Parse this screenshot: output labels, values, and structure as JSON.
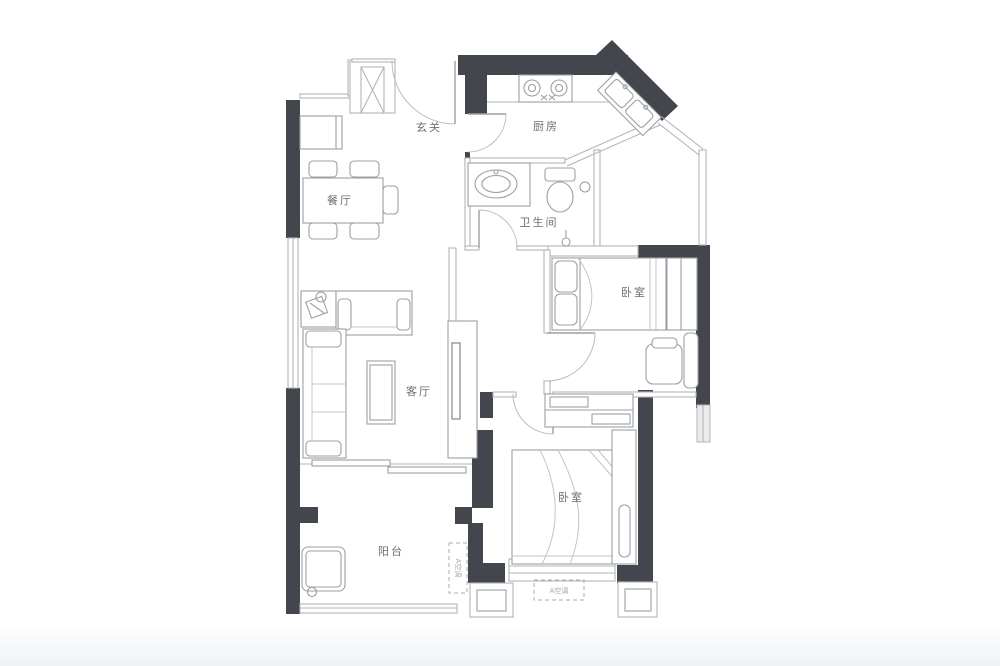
{
  "colors": {
    "wall": "#43464c",
    "line": "#b2b5b8",
    "furniture": "#9ba0a4",
    "label": "#6b7074",
    "background": "#ffffff"
  },
  "rooms": [
    {
      "id": "entry",
      "label": "玄关"
    },
    {
      "id": "kitchen",
      "label": "厨房"
    },
    {
      "id": "dining",
      "label": "餐厅"
    },
    {
      "id": "bathroom",
      "label": "卫生间"
    },
    {
      "id": "bedroom-north",
      "label": "卧室"
    },
    {
      "id": "living",
      "label": "客厅"
    },
    {
      "id": "bedroom-south",
      "label": "卧室"
    },
    {
      "id": "balcony",
      "label": "阳台"
    }
  ],
  "annotations": [
    {
      "id": "ac-balcony",
      "label": "A空调"
    },
    {
      "id": "ac-south",
      "label": "A空调"
    }
  ]
}
